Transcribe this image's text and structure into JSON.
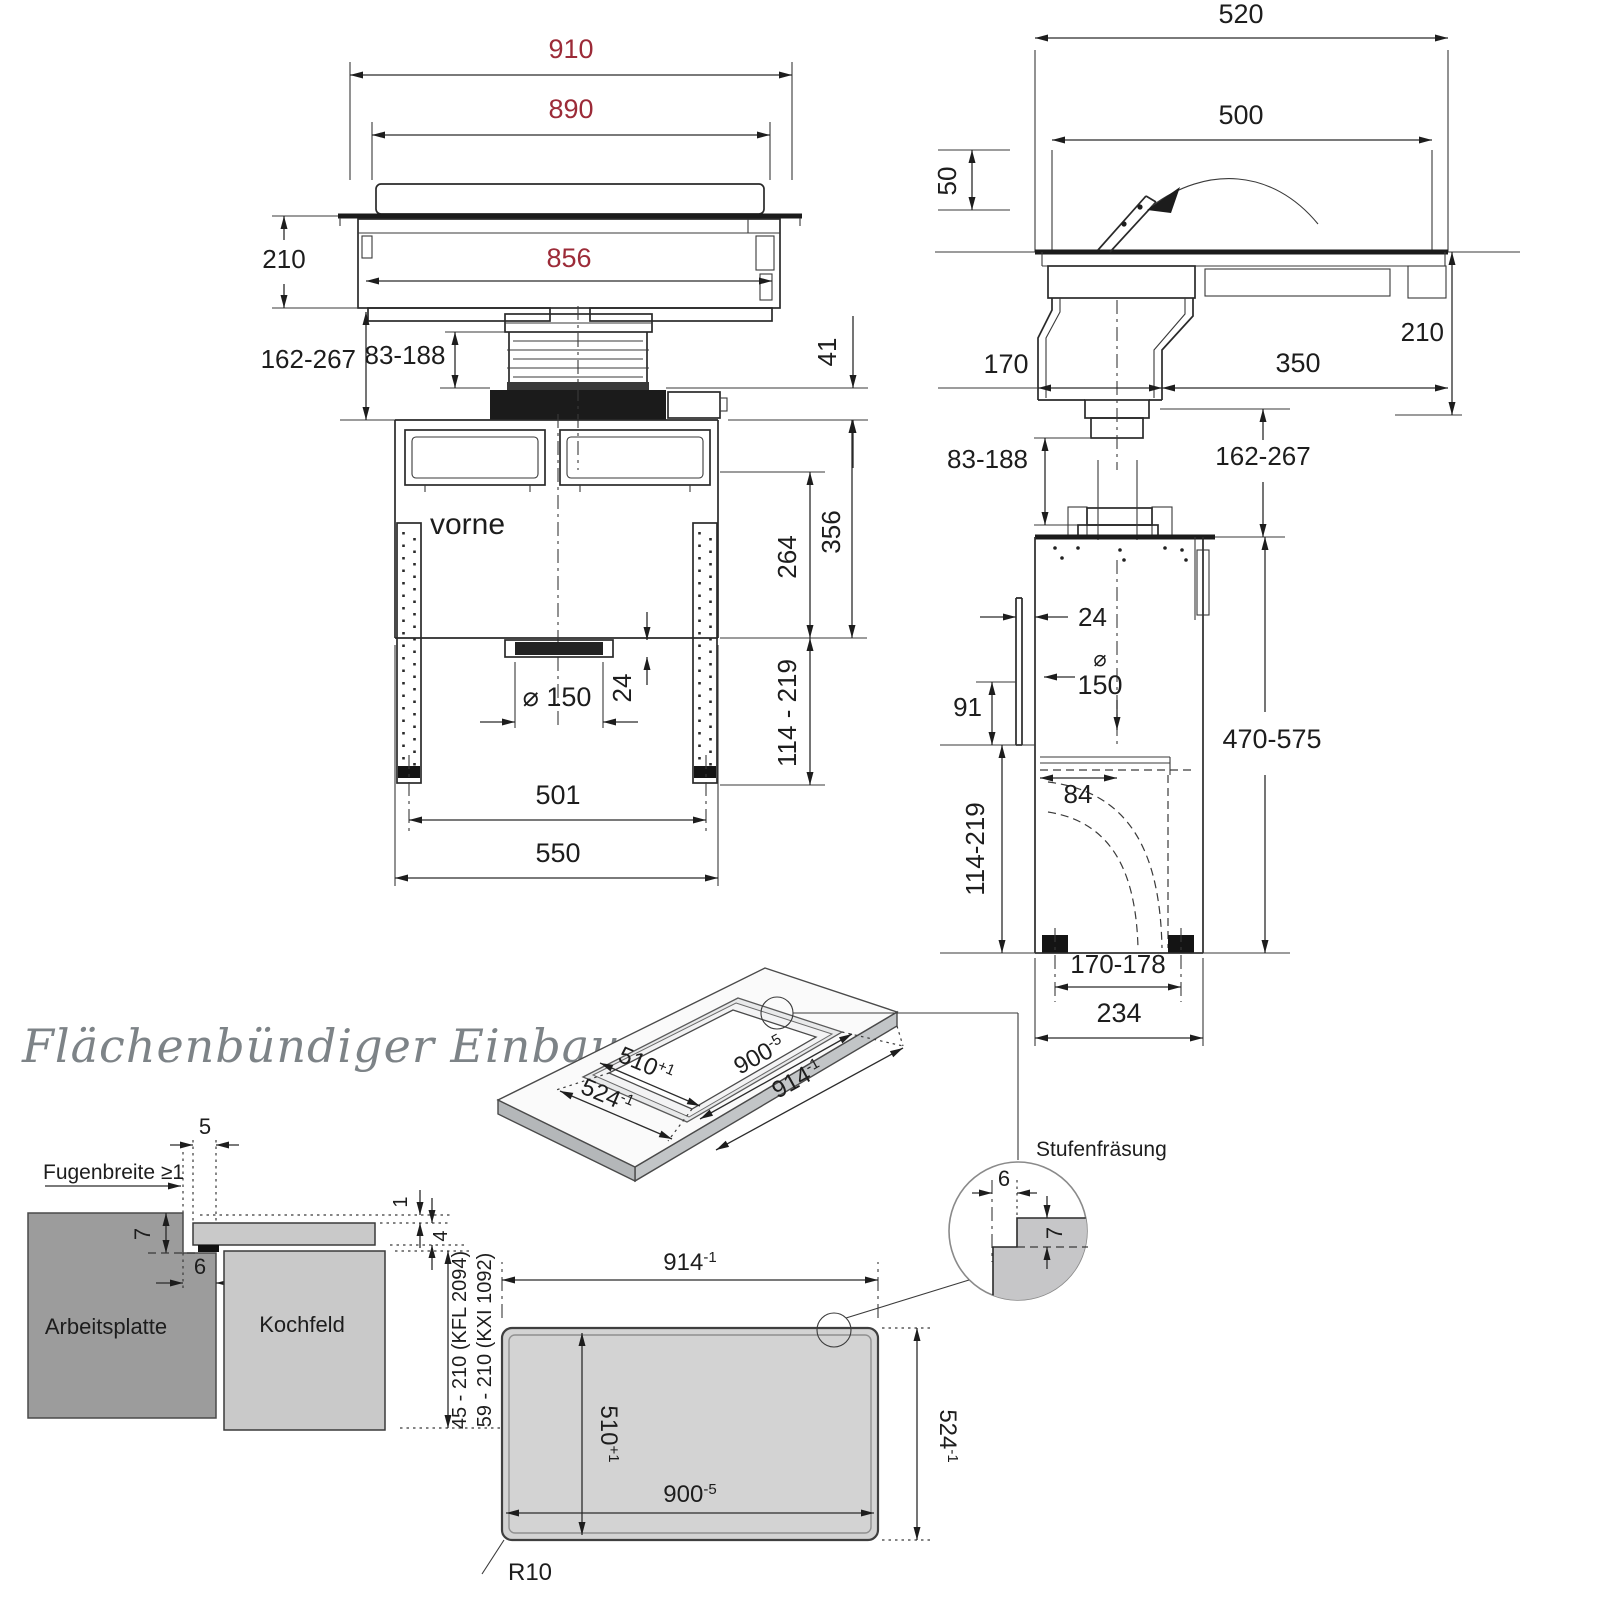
{
  "drawing": {
    "colors": {
      "dim_red": "#9c2b38",
      "line": "#2a2a2a",
      "title_gray": "#7d8387",
      "worktop_gray": "#9c9c9c",
      "hob_gray": "#c9c9c9",
      "panel_gray": "#d3d3d3"
    }
  },
  "front_view": {
    "dim_outer_width": "910",
    "dim_glass_width": "890",
    "dim_inner_width": "856",
    "dim_body_height": "210",
    "dim_install_height": "162-267",
    "dim_duct_height": "83-188",
    "dim_offset": "41"
  },
  "side_view": {
    "dim_outer_depth": "520",
    "dim_glass_depth": "500",
    "dim_flap_height": "50",
    "dim_duct_width": "170",
    "dim_rear_depth": "350",
    "dim_body_height": "210"
  },
  "bottom_view": {
    "front_label": "vorne",
    "dim_opening_height": "264",
    "dim_total_height": "356",
    "dim_collar_height": "24",
    "dim_duct_dia": "⌀ 150",
    "dim_leg_range": "114 - 219",
    "dim_rail_spacing": "501",
    "dim_total_width": "550"
  },
  "blower_view": {
    "dim_duct_height": "83-188",
    "dim_install_height": "162-267",
    "dim_rail_offset": "24",
    "dia_symbol": "⌀",
    "dia_value": "150",
    "dim_slot_height": "91",
    "dim_total_height": "470-575",
    "dim_lower_height": "114-219",
    "dim_center_offset": "84",
    "dim_foot_spacing": "170-178",
    "dim_total_depth": "234"
  },
  "flush_section": {
    "title": "Flächenbündiger Einbau",
    "joint_label": "Fugenbreite ≥1",
    "dim_edge": "5",
    "dim_step_depth": "7",
    "dim_step_width": "6",
    "dim_gap": "1",
    "dim_glass_thickness": "4",
    "worktop_label": "Arbeitsplatte",
    "hob_label": "Kochfeld",
    "range_kfl": "45 - 210 (KFL 2094)",
    "range_kxi": "59 - 210 (KXI 1092)"
  },
  "iso_view": {
    "dim_width_inner": {
      "value": "510",
      "tol": "+1"
    },
    "dim_width_outer": {
      "value": "524",
      "tol": "-1"
    },
    "dim_length_inner": {
      "value": "900",
      "tol": "-5"
    },
    "dim_length_outer": {
      "value": "914",
      "tol": "-1"
    }
  },
  "detail_view": {
    "label": "Stufenfräsung",
    "dim_step_width": "6",
    "dim_step_depth": "7"
  },
  "panel_view": {
    "dim_length_outer": {
      "value": "914",
      "tol": "-1"
    },
    "dim_width_inner": {
      "value": "510",
      "tol": "+1"
    },
    "dim_length_inner": {
      "value": "900",
      "tol": "-5"
    },
    "dim_width_outer": {
      "value": "524",
      "tol": "-1"
    },
    "corner_radius": "R10"
  }
}
